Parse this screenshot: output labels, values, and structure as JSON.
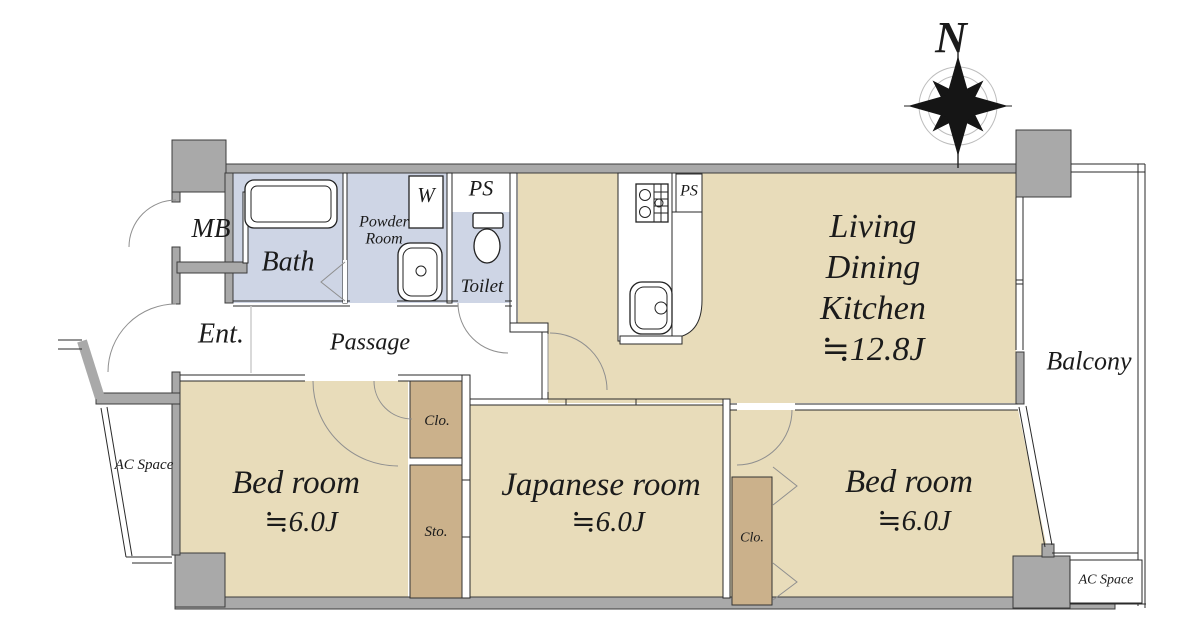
{
  "colors": {
    "room": "#e8dcba",
    "closet": "#cbb18b",
    "wet": "#ced5e5",
    "wall": "#a9a9a9",
    "line": "#222222"
  },
  "compass": {
    "north_label": "N"
  },
  "rooms": {
    "ldk": {
      "line1": "Living",
      "line2": "Dining",
      "line3": "Kitchen",
      "size": "≒12.8J"
    },
    "bedroom_left": {
      "name": "Bed room",
      "size": "≒6.0J"
    },
    "japanese_room": {
      "name": "Japanese room",
      "size": "≒6.0J"
    },
    "bedroom_right": {
      "name": "Bed room",
      "size": "≒6.0J"
    },
    "balcony": {
      "name": "Balcony"
    },
    "bath": {
      "name": "Bath"
    },
    "powder_room": {
      "name": "Powder Room"
    },
    "toilet": {
      "name": "Toilet"
    },
    "entrance": {
      "name": "Ent."
    },
    "passage": {
      "name": "Passage"
    },
    "meter_box": {
      "name": "MB"
    },
    "pipe_space_top": {
      "name": "PS"
    },
    "pipe_space_kitchen": {
      "name": "PS"
    },
    "washer": {
      "name": "W"
    },
    "closet_left": {
      "name": "Clo."
    },
    "storage": {
      "name": "Sto."
    },
    "closet_right": {
      "name": "Clo."
    },
    "ac_space_left": {
      "name": "AC Space"
    },
    "ac_space_right": {
      "name": "AC Space"
    }
  }
}
